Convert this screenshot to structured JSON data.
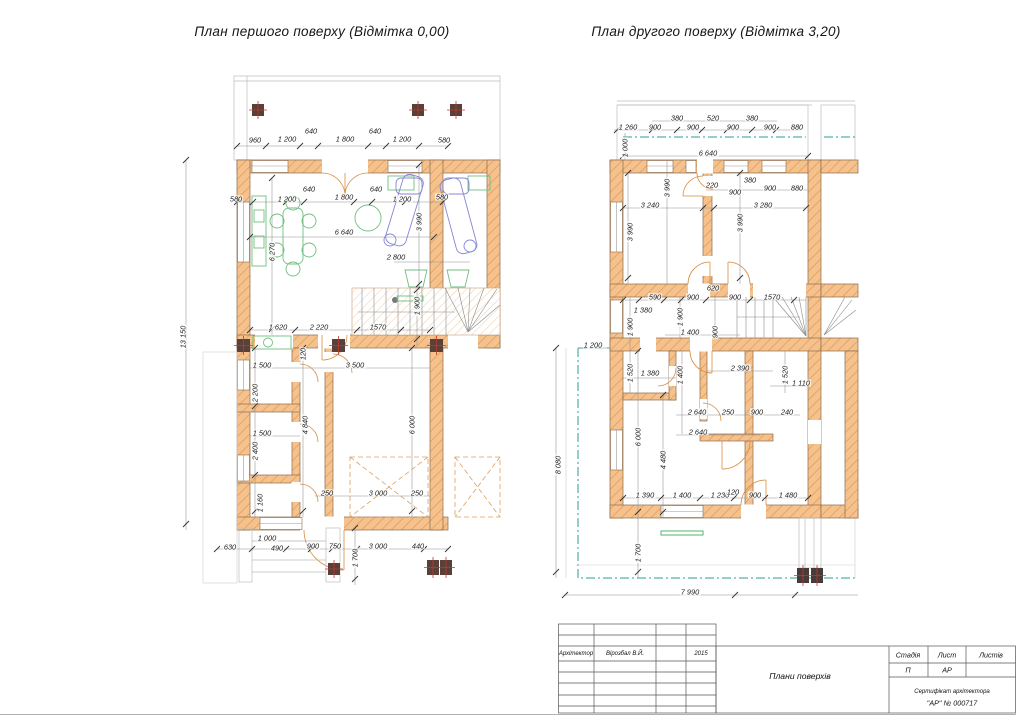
{
  "titles": {
    "left": "План  першого поверху (Відмітка 0,00)",
    "right": "План  другого поверху (Відмітка 3,20)"
  },
  "colors": {
    "wall_fill": "#f5c28d",
    "wall_hatch": "#e2a265",
    "wall_outline": "#8d6b4a",
    "dimension_line": "#8f8f8f",
    "teal_dashdot": "#2e9e96",
    "furniture_green": "#6fbf7f",
    "furniture_blue": "#8585d6",
    "column_fill": "#5a4038",
    "column_cross": "#c0392b",
    "dashed_roof": "#dda05f"
  },
  "plans": {
    "left": {
      "dims": [
        {
          "t": "960",
          "x": 255,
          "y": 140
        },
        {
          "t": "1 200",
          "x": 287,
          "y": 139
        },
        {
          "t": "640",
          "x": 311,
          "y": 131
        },
        {
          "t": "1 800",
          "x": 345,
          "y": 139
        },
        {
          "t": "640",
          "x": 375,
          "y": 131
        },
        {
          "t": "1 200",
          "x": 402,
          "y": 139
        },
        {
          "t": "580",
          "x": 444,
          "y": 140
        },
        {
          "t": "580",
          "x": 236,
          "y": 199
        },
        {
          "t": "1 200",
          "x": 287,
          "y": 199
        },
        {
          "t": "640",
          "x": 309,
          "y": 189
        },
        {
          "t": "1 800",
          "x": 344,
          "y": 197
        },
        {
          "t": "640",
          "x": 376,
          "y": 189
        },
        {
          "t": "1 200",
          "x": 402,
          "y": 199
        },
        {
          "t": "580",
          "x": 442,
          "y": 197
        },
        {
          "t": "6 640",
          "x": 344,
          "y": 232
        },
        {
          "t": "6 270",
          "x": 272,
          "y": 252,
          "r": 1
        },
        {
          "t": "3 990",
          "x": 419,
          "y": 222,
          "r": 1
        },
        {
          "t": "2 800",
          "x": 396,
          "y": 257
        },
        {
          "t": "1 900",
          "x": 417,
          "y": 306,
          "r": 1
        },
        {
          "t": "1570",
          "x": 378,
          "y": 327
        },
        {
          "t": "2 220",
          "x": 319,
          "y": 327
        },
        {
          "t": "1 620",
          "x": 278,
          "y": 327
        },
        {
          "t": "1 500",
          "x": 262,
          "y": 365
        },
        {
          "t": "120",
          "x": 303,
          "y": 354,
          "r": 1
        },
        {
          "t": "3 500",
          "x": 355,
          "y": 365
        },
        {
          "t": "2 200",
          "x": 255,
          "y": 393,
          "r": 1
        },
        {
          "t": "4 840",
          "x": 305,
          "y": 425,
          "r": 1
        },
        {
          "t": "6 000",
          "x": 412,
          "y": 425,
          "r": 1
        },
        {
          "t": "1 500",
          "x": 262,
          "y": 433
        },
        {
          "t": "2 400",
          "x": 255,
          "y": 451,
          "r": 1
        },
        {
          "t": "1 160",
          "x": 260,
          "y": 503,
          "r": 1
        },
        {
          "t": "250",
          "x": 327,
          "y": 493
        },
        {
          "t": "3 000",
          "x": 378,
          "y": 493
        },
        {
          "t": "250",
          "x": 417,
          "y": 493
        },
        {
          "t": "630",
          "x": 230,
          "y": 547
        },
        {
          "t": "1 000",
          "x": 267,
          "y": 538
        },
        {
          "t": "490",
          "x": 277,
          "y": 548
        },
        {
          "t": "900",
          "x": 313,
          "y": 546
        },
        {
          "t": "750",
          "x": 335,
          "y": 546
        },
        {
          "t": "1 700",
          "x": 355,
          "y": 558,
          "r": 1
        },
        {
          "t": "3 000",
          "x": 378,
          "y": 546
        },
        {
          "t": "440",
          "x": 418,
          "y": 546
        },
        {
          "t": "13 150",
          "x": 183,
          "y": 337,
          "r": 1
        }
      ]
    },
    "right": {
      "dims": [
        {
          "t": "380",
          "x": 677,
          "y": 118
        },
        {
          "t": "520",
          "x": 713,
          "y": 118
        },
        {
          "t": "380",
          "x": 752,
          "y": 118
        },
        {
          "t": "1 260",
          "x": 628,
          "y": 127
        },
        {
          "t": "900",
          "x": 655,
          "y": 127
        },
        {
          "t": "900",
          "x": 693,
          "y": 127
        },
        {
          "t": "900",
          "x": 733,
          "y": 127
        },
        {
          "t": "900",
          "x": 770,
          "y": 127
        },
        {
          "t": "880",
          "x": 797,
          "y": 127
        },
        {
          "t": "1 000",
          "x": 625,
          "y": 148,
          "r": 1
        },
        {
          "t": "6 640",
          "x": 708,
          "y": 153
        },
        {
          "t": "220",
          "x": 712,
          "y": 185
        },
        {
          "t": "380",
          "x": 750,
          "y": 180
        },
        {
          "t": "900",
          "x": 735,
          "y": 192
        },
        {
          "t": "900",
          "x": 770,
          "y": 188
        },
        {
          "t": "880",
          "x": 797,
          "y": 188
        },
        {
          "t": "3 990",
          "x": 667,
          "y": 188,
          "r": 1
        },
        {
          "t": "3 240",
          "x": 650,
          "y": 205
        },
        {
          "t": "3 280",
          "x": 763,
          "y": 205
        },
        {
          "t": "3 990",
          "x": 630,
          "y": 232,
          "r": 1
        },
        {
          "t": "3 990",
          "x": 740,
          "y": 223,
          "r": 1
        },
        {
          "t": "620",
          "x": 713,
          "y": 288
        },
        {
          "t": "590",
          "x": 655,
          "y": 297
        },
        {
          "t": "900",
          "x": 693,
          "y": 297
        },
        {
          "t": "900",
          "x": 735,
          "y": 297
        },
        {
          "t": "1570",
          "x": 772,
          "y": 297
        },
        {
          "t": "1 380",
          "x": 643,
          "y": 310
        },
        {
          "t": "1 900",
          "x": 630,
          "y": 327,
          "r": 1
        },
        {
          "t": "1 900",
          "x": 680,
          "y": 317,
          "r": 1
        },
        {
          "t": "1 400",
          "x": 690,
          "y": 332
        },
        {
          "t": "900",
          "x": 715,
          "y": 332,
          "r": 1
        },
        {
          "t": "1 200",
          "x": 593,
          "y": 345
        },
        {
          "t": "1 520",
          "x": 630,
          "y": 373,
          "r": 1
        },
        {
          "t": "1 380",
          "x": 650,
          "y": 373
        },
        {
          "t": "1 400",
          "x": 680,
          "y": 375,
          "r": 1
        },
        {
          "t": "2 390",
          "x": 740,
          "y": 368
        },
        {
          "t": "1 520",
          "x": 785,
          "y": 375,
          "r": 1
        },
        {
          "t": "1 110",
          "x": 801,
          "y": 383
        },
        {
          "t": "2 640",
          "x": 697,
          "y": 412
        },
        {
          "t": "250",
          "x": 728,
          "y": 412
        },
        {
          "t": "900",
          "x": 757,
          "y": 412
        },
        {
          "t": "240",
          "x": 787,
          "y": 412
        },
        {
          "t": "2 640",
          "x": 698,
          "y": 432
        },
        {
          "t": "6 000",
          "x": 638,
          "y": 437,
          "r": 1
        },
        {
          "t": "4 480",
          "x": 663,
          "y": 460,
          "r": 1
        },
        {
          "t": "1 390",
          "x": 645,
          "y": 495
        },
        {
          "t": "1 400",
          "x": 682,
          "y": 495
        },
        {
          "t": "1 230",
          "x": 720,
          "y": 495
        },
        {
          "t": "120",
          "x": 733,
          "y": 492
        },
        {
          "t": "900",
          "x": 755,
          "y": 495
        },
        {
          "t": "1 480",
          "x": 788,
          "y": 495
        },
        {
          "t": "1 700",
          "x": 638,
          "y": 553,
          "r": 1
        },
        {
          "t": "7 990",
          "x": 690,
          "y": 592
        },
        {
          "t": "8 080",
          "x": 558,
          "y": 465,
          "r": 1
        }
      ]
    }
  },
  "titleblock": {
    "architect_label": "Архітектор",
    "architect_name": "Вірозбал В.Й.",
    "year": "2015",
    "doc_title": "Плани  поверхів",
    "stage_label": "Стадія",
    "sheet_label": "Лист",
    "sheets_label": "Листів",
    "stage_value": "П",
    "sheet_value": "АР",
    "cert_line1": "Сертифікат архітектора",
    "cert_line2": "\"АР\" № 000717"
  }
}
